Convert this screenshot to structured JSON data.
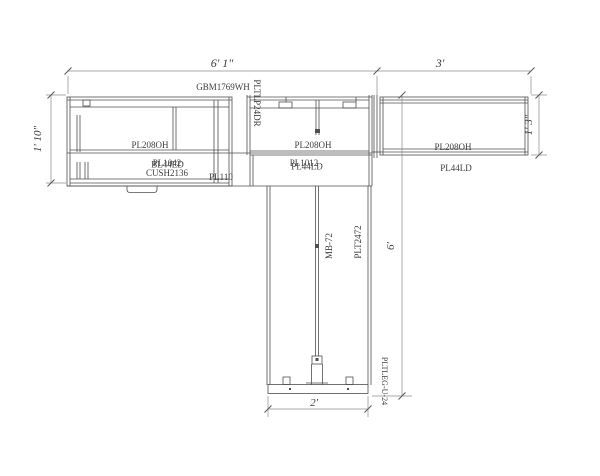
{
  "drawing": {
    "dims": {
      "top_width": "6' 1\"",
      "top_right_width": "3'",
      "left_height": "1' 10\"",
      "right_height": "1' 3\"",
      "total_height": "6'",
      "base_width": "2'"
    },
    "parts": {
      "countertop": "GBM1769WH",
      "top_drawer_unit": "PLTLP24DR",
      "left_overhead": "PL208OH",
      "center_overhead": "PL208OH",
      "right_overhead": "PL208OH",
      "left_lower_a": "PL1042",
      "left_lower_b": "BL44ED",
      "cushion": "CUSH2136",
      "left_filler": "PL110",
      "center_lower_a": "PL1012",
      "center_lower_b": "PL44LD",
      "right_lower": "PL44LD",
      "mount_bracket": "MB-72",
      "panel": "PLT2472",
      "leg": "PLTLEG-U-24"
    },
    "colors": {
      "object_line": "#4f4f4f",
      "dimension_line": "#8c8c8c",
      "text": "#3c3c3c",
      "background": "#ffffff"
    }
  }
}
